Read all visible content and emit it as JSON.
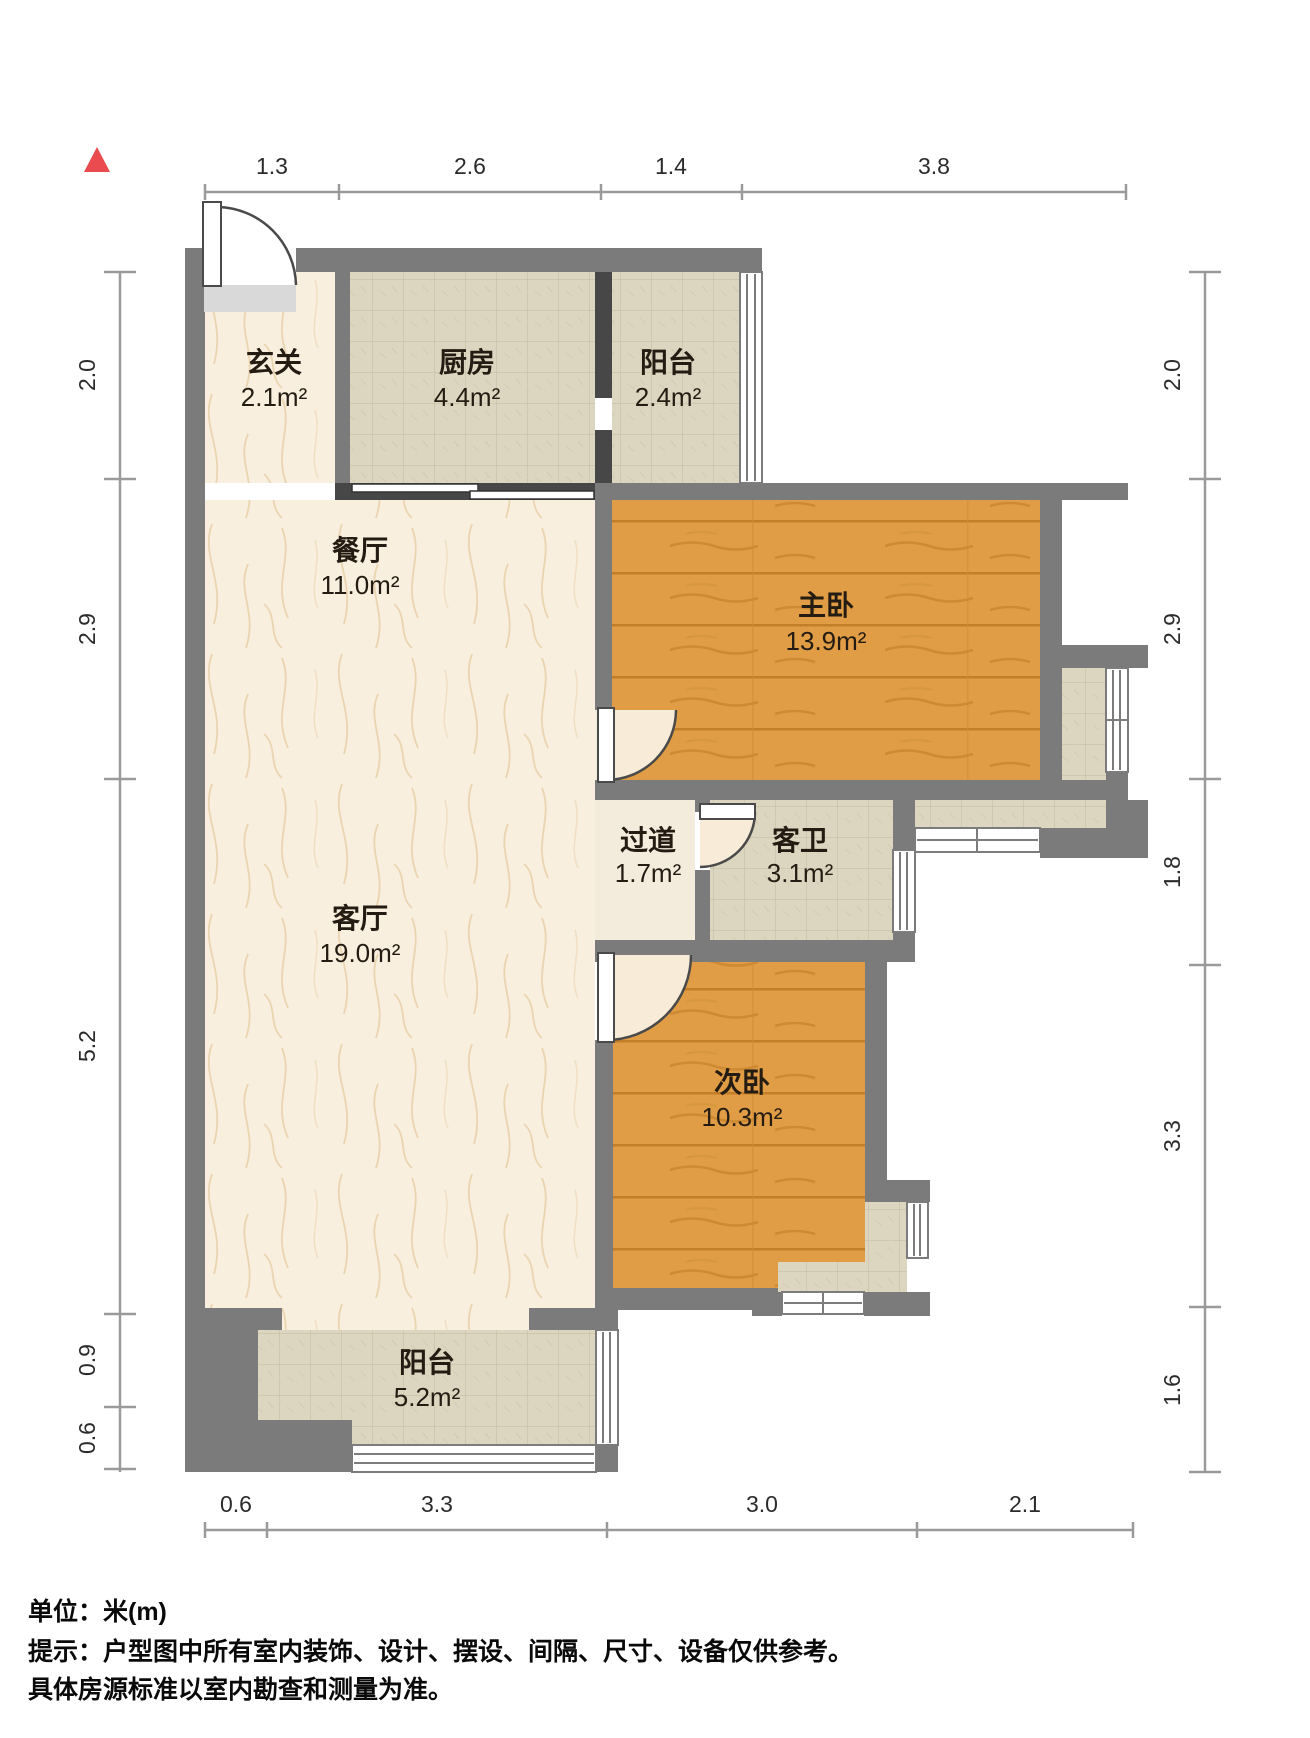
{
  "colors": {
    "wall": "#7b7b7b",
    "wall_dark": "#474747",
    "wood_floor": "#e09d45",
    "tile_floor": "#dcd6c0",
    "marble_floor": "#f8efdf",
    "hall_floor": "#f3ecdc",
    "north_arrow": "#e94b4e",
    "dimension_line": "#9a9a9a",
    "label_text": "#241c12"
  },
  "rooms": [
    {
      "name": "玄关",
      "area": "2.1m²"
    },
    {
      "name": "厨房",
      "area": "4.4m²"
    },
    {
      "name": "阳台",
      "area": "2.4m²"
    },
    {
      "name": "餐厅",
      "area": "11.0m²"
    },
    {
      "name": "主卧",
      "area": "13.9m²"
    },
    {
      "name": "过道",
      "area": "1.7m²"
    },
    {
      "name": "客卫",
      "area": "3.1m²"
    },
    {
      "name": "客厅",
      "area": "19.0m²"
    },
    {
      "name": "次卧",
      "area": "10.3m²"
    },
    {
      "name": "阳台",
      "area": "5.2m²"
    }
  ],
  "dimensions": {
    "top": [
      "1.3",
      "2.6",
      "1.4",
      "3.8"
    ],
    "left": [
      "2.0",
      "2.9",
      "5.2",
      "0.9",
      "0.6"
    ],
    "right": [
      "2.0",
      "2.9",
      "1.8",
      "3.3",
      "1.6"
    ],
    "bottom": [
      "0.6",
      "3.3",
      "3.0",
      "2.1"
    ]
  },
  "footer": {
    "unit_line": "单位：米(m)",
    "tip_line": "提示：户型图中所有室内装饰、设计、摆设、间隔、尺寸、设备仅供参考。",
    "tip_line2": "具体房源标准以室内勘查和测量为准。"
  }
}
